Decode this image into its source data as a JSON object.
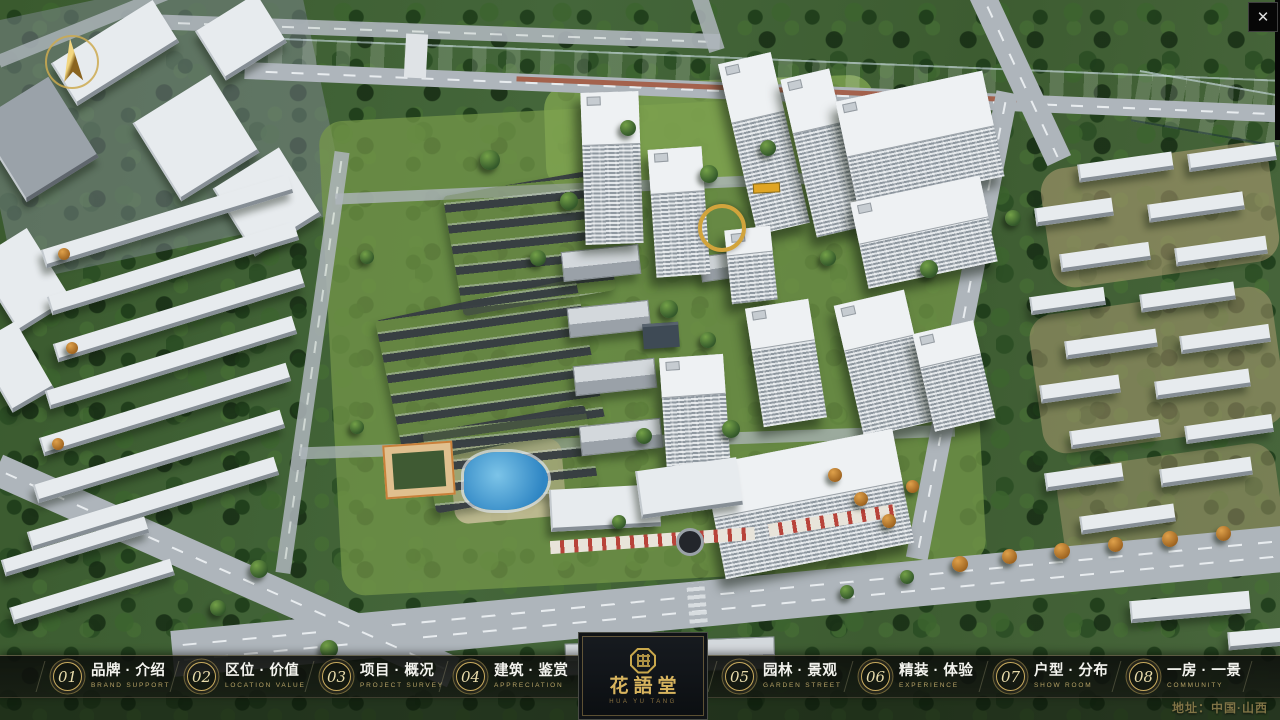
{
  "window": {
    "close_glyph": "✕"
  },
  "project": {
    "title": "花語堂",
    "subtitle": "HUA YU TANG",
    "address": "地址：中国·山西"
  },
  "navbar": {
    "items": [
      {
        "num": "01",
        "zh": "品牌 · 介绍",
        "en": "BRAND SUPPORT"
      },
      {
        "num": "02",
        "zh": "区位 · 价值",
        "en": "LOCATION VALUE"
      },
      {
        "num": "03",
        "zh": "项目 · 概况",
        "en": "PROJECT SURVEY"
      },
      {
        "num": "04",
        "zh": "建筑 · 鉴赏",
        "en": "APPRECIATION"
      },
      {
        "num": "05",
        "zh": "园林 · 景观",
        "en": "GARDEN STREET"
      },
      {
        "num": "06",
        "zh": "精装 · 体验",
        "en": "EXPERIENCE"
      },
      {
        "num": "07",
        "zh": "户型 · 分布",
        "en": "SHOW ROOM"
      },
      {
        "num": "08",
        "zh": "一房 · 一景",
        "en": "COMMUNITY"
      }
    ]
  },
  "colors": {
    "accent_gold": "#c9a84c",
    "title_gold": "#d8b45e",
    "bar_background": "rgba(12,14,11,0.88)",
    "river_blue": "#3c86c6",
    "address_bronze": "#8b7c4b"
  }
}
